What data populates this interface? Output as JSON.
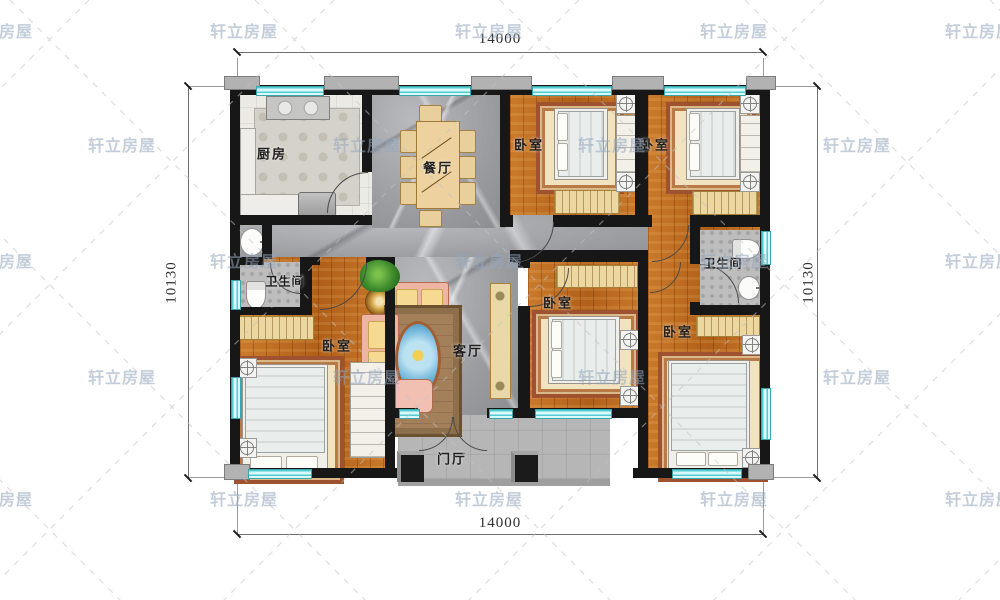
{
  "watermark": {
    "text": "轩立房屋"
  },
  "dimensions": {
    "top": "14000",
    "bottom": "14000",
    "left": "10130",
    "right": "10130"
  },
  "rooms": {
    "kitchen": "厨房",
    "dining": "餐厅",
    "living": "客厅",
    "entry": "门厅",
    "bedroom": "卧室",
    "bathroom": "卫生间"
  },
  "colors": {
    "wall": "#171717",
    "window_glass": "#8ae0e5",
    "wood_floor": "#bf6c20",
    "marble_floor": "#a4a5a9",
    "porch_slab": "#b6b6b6",
    "watermark_text": "#94a6be"
  }
}
